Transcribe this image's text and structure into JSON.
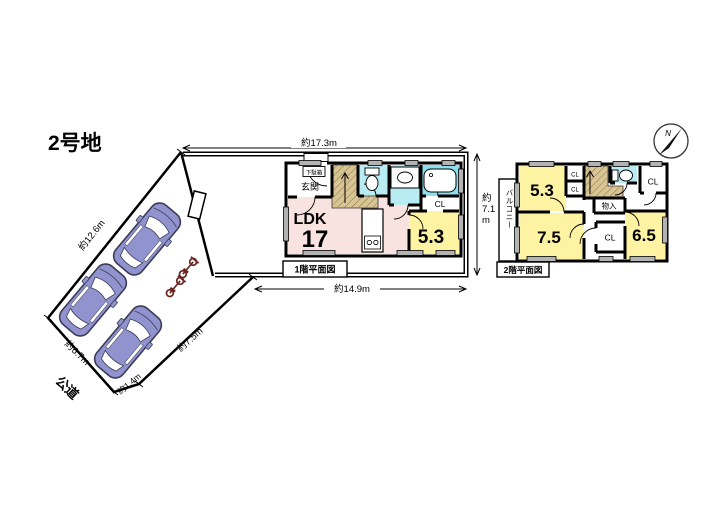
{
  "title": "2号地",
  "compass": {
    "north_label": "N"
  },
  "site": {
    "dim_top": "約17.3m",
    "dim_right": {
      "line1": "約",
      "line2": "7.1",
      "line3": "m"
    },
    "dim_bottom": "約14.9m",
    "dim_left_diagonal": "約12.6m",
    "dim_road_edge": "約6.7m",
    "dim_corner": "約1.4m",
    "dim_right_diagonal": "約7.5m",
    "road_label": "公道"
  },
  "floor1": {
    "plan_label": "1階平面図",
    "entrance": "玄関",
    "shoe_cabinet": "下駄箱",
    "ldk_label": "LDK",
    "ldk_size": "17",
    "room_size": "5.3",
    "closet": "CL"
  },
  "floor2": {
    "plan_label": "2階平面図",
    "balcony": "バルコニー",
    "room_a": "5.3",
    "room_b": "7.5",
    "room_c": "6.5",
    "closet_a": "CL",
    "closet_b": "CL",
    "closet_c": "CL",
    "closet_d": "CL",
    "storage": "物入"
  },
  "colors": {
    "ldk_pink": "#f8e3e0",
    "room_yellow": "#fdf3a3",
    "wet_area_cyan": "#b9ebf2",
    "bath_cyan": "#8edfee",
    "stair_tan": "#d9c493",
    "car_body": "#9193cf",
    "bike_maroon": "#6b241f",
    "window_gray": "#b3b3b3"
  }
}
